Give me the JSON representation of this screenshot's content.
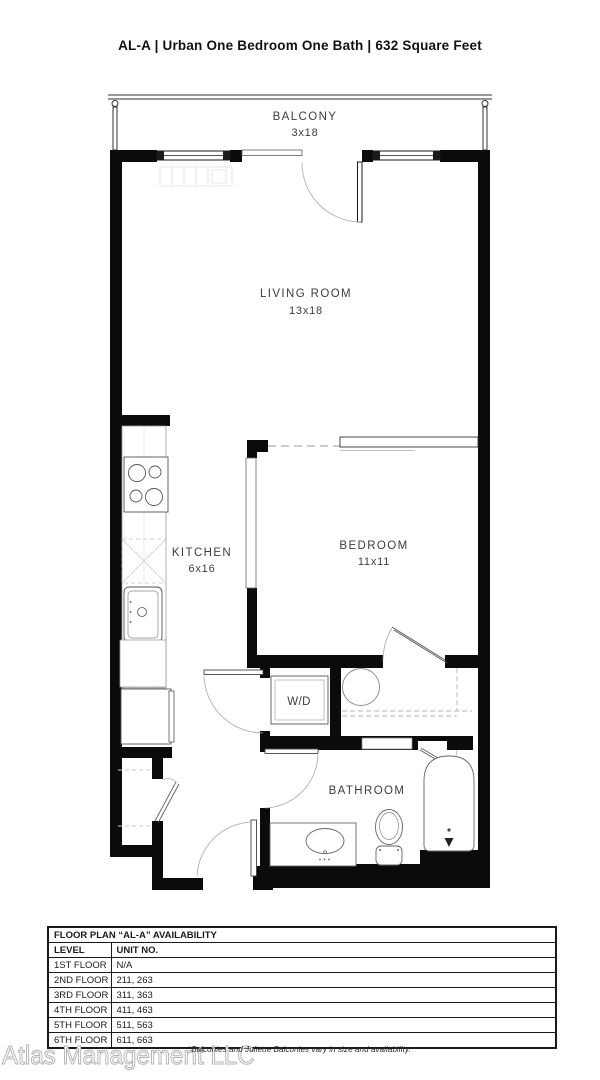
{
  "title": "AL-A | Urban One Bedroom One Bath | 632  Square Feet",
  "plan": {
    "balcony": {
      "name": "BALCONY",
      "dims": "3x18"
    },
    "living_room": {
      "name": "LIVING ROOM",
      "dims": "13x18"
    },
    "kitchen": {
      "name": "KITCHEN",
      "dims": "6x16"
    },
    "bedroom": {
      "name": "BEDROOM",
      "dims": "11x11"
    },
    "bathroom": {
      "name": "BATHROOM"
    },
    "washer_dryer": {
      "name": "W/D"
    }
  },
  "availability_table": {
    "title": "FLOOR PLAN “AL-A” AVAILABILITY",
    "columns": [
      "LEVEL",
      "UNIT NO."
    ],
    "rows": [
      {
        "level": "1ST FLOOR",
        "units": "N/A"
      },
      {
        "level": "2ND FLOOR",
        "units": "211, 263"
      },
      {
        "level": "3RD FLOOR",
        "units": "311, 363"
      },
      {
        "level": "4TH FLOOR",
        "units": "411, 463"
      },
      {
        "level": "5TH FLOOR",
        "units": "511, 563"
      },
      {
        "level": "6TH FLOOR",
        "units": "611, 663"
      }
    ]
  },
  "footnote": "*Balconies and Juliette Balconies vary in size and availability.",
  "watermark": "Atlas Management LLC",
  "colors": {
    "wall": "#0b0b0b",
    "fixture": "#5a5a5a",
    "arc": "#a8a8a8",
    "label": "#3d3d3d"
  }
}
